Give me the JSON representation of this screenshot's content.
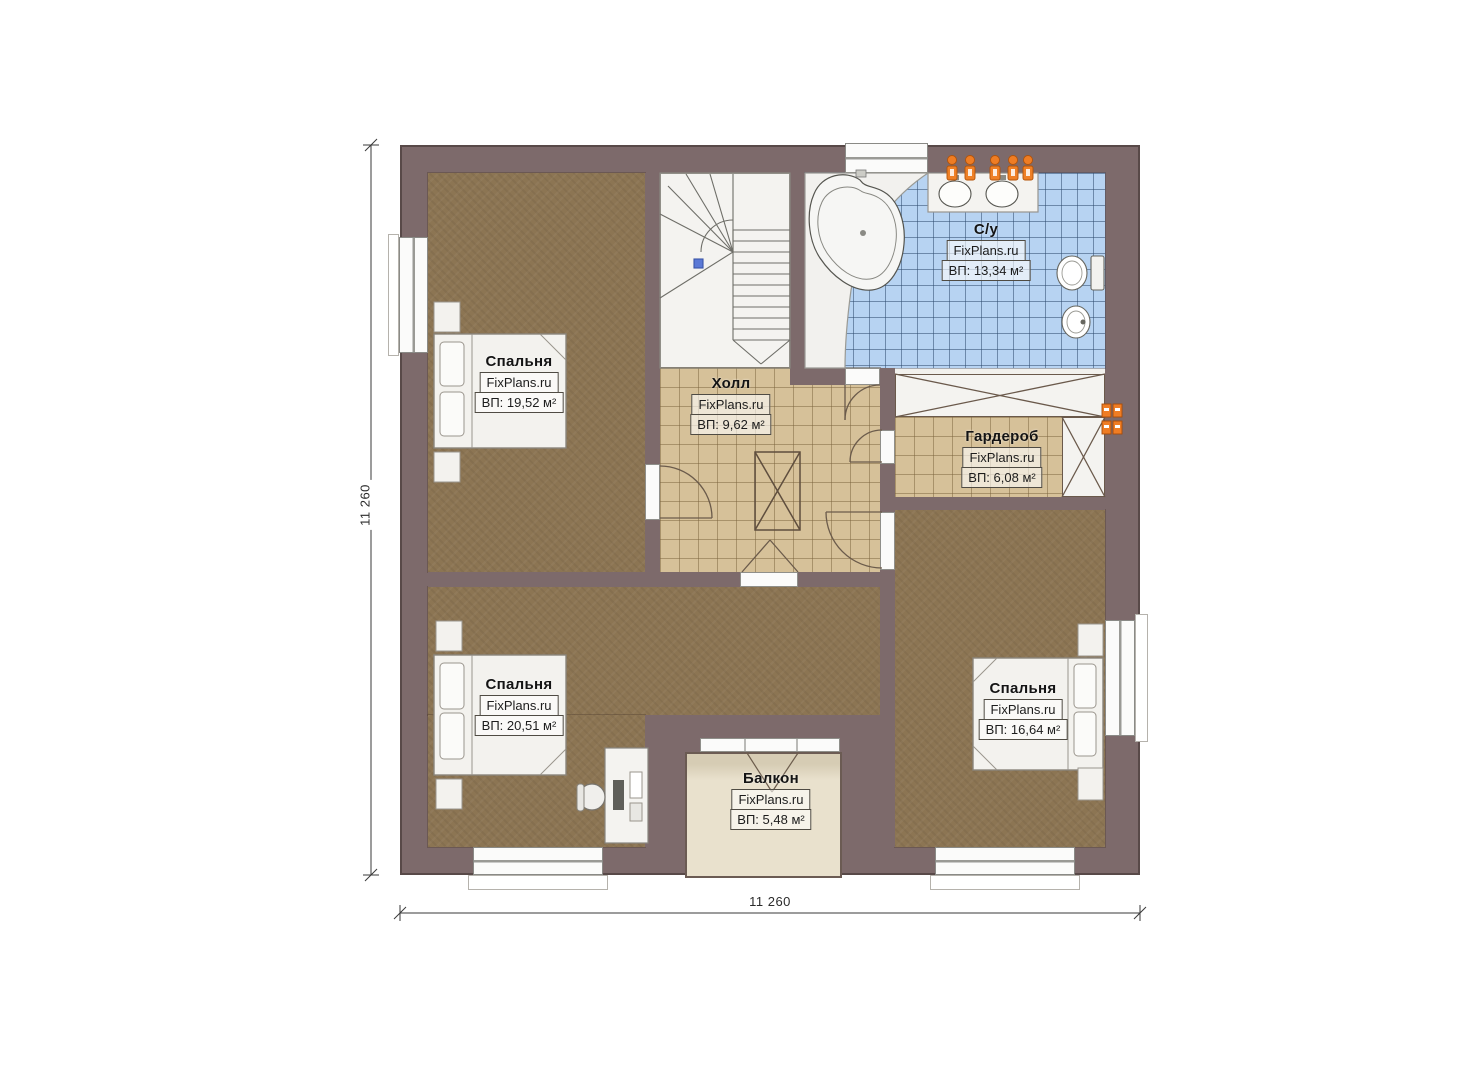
{
  "watermark": "FixPlans.ru",
  "rooms": [
    {
      "id": "bedroom-top-left",
      "name": "Спальня",
      "area": "ВП: 19,52 м²"
    },
    {
      "id": "bathroom",
      "name": "С/у",
      "area": "ВП: 13,34 м²"
    },
    {
      "id": "hall",
      "name": "Холл",
      "area": "ВП: 9,62 м²"
    },
    {
      "id": "wardrobe",
      "name": "Гардероб",
      "area": "ВП: 6,08 м²"
    },
    {
      "id": "bedroom-bottom-left",
      "name": "Спальня",
      "area": "ВП: 20,51 м²"
    },
    {
      "id": "bedroom-bottom-right",
      "name": "Спальня",
      "area": "ВП: 16,64 м²"
    },
    {
      "id": "balcony",
      "name": "Балкон",
      "area": "ВП: 5,48 м²"
    }
  ],
  "dimensions": {
    "bottom": "11 260",
    "left": "11 260"
  },
  "colors": {
    "wall": "#7d6a6b",
    "bedroom_floor": "#8c7553",
    "hall_floor": "#d6c199",
    "bath_tile": "#b7d3f2",
    "balcony_floor": "#e9e1cd",
    "fixture_orange": "#ef7d24",
    "stair_marker_blue": "#5b79d6"
  }
}
